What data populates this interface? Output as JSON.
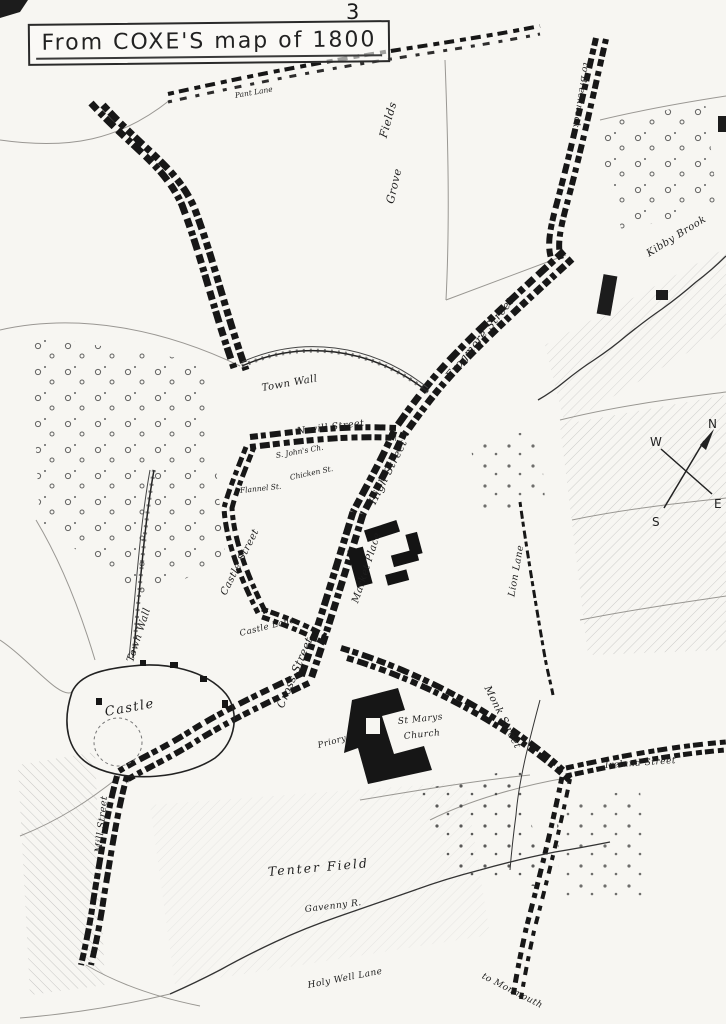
{
  "page": {
    "number": "3"
  },
  "title": {
    "text": "From COXE'S map of 1800"
  },
  "compass": {
    "n": "N",
    "e": "E",
    "s": "S",
    "w": "W"
  },
  "map": {
    "labels": [
      {
        "text": "Fields"
      },
      {
        "text": "Grove"
      },
      {
        "text": "Pant Lane"
      },
      {
        "text": "to Brecknock"
      },
      {
        "text": "Kibby Brook"
      },
      {
        "text": "Frogmore Street"
      },
      {
        "text": "Town Wall"
      },
      {
        "text": "Nevill Street"
      },
      {
        "text": "S. John's Ch."
      },
      {
        "text": "Chicken St."
      },
      {
        "text": "Flannel St."
      },
      {
        "text": "High Street"
      },
      {
        "text": "Market Place"
      },
      {
        "text": "Castle Street"
      },
      {
        "text": "Town Wall"
      },
      {
        "text": "Castle Lane"
      },
      {
        "text": "Cross Street"
      },
      {
        "text": "Lion Lane"
      },
      {
        "text": "Castle"
      },
      {
        "text": "St Marys"
      },
      {
        "text": "Church"
      },
      {
        "text": "Monk Street"
      },
      {
        "text": "Priory"
      },
      {
        "text": "Ireland Street"
      },
      {
        "text": "Tenter Field"
      },
      {
        "text": "Gavenny R."
      },
      {
        "text": "Mill Street"
      },
      {
        "text": "Holy Well Lane"
      },
      {
        "text": "to Monmouth"
      }
    ]
  }
}
